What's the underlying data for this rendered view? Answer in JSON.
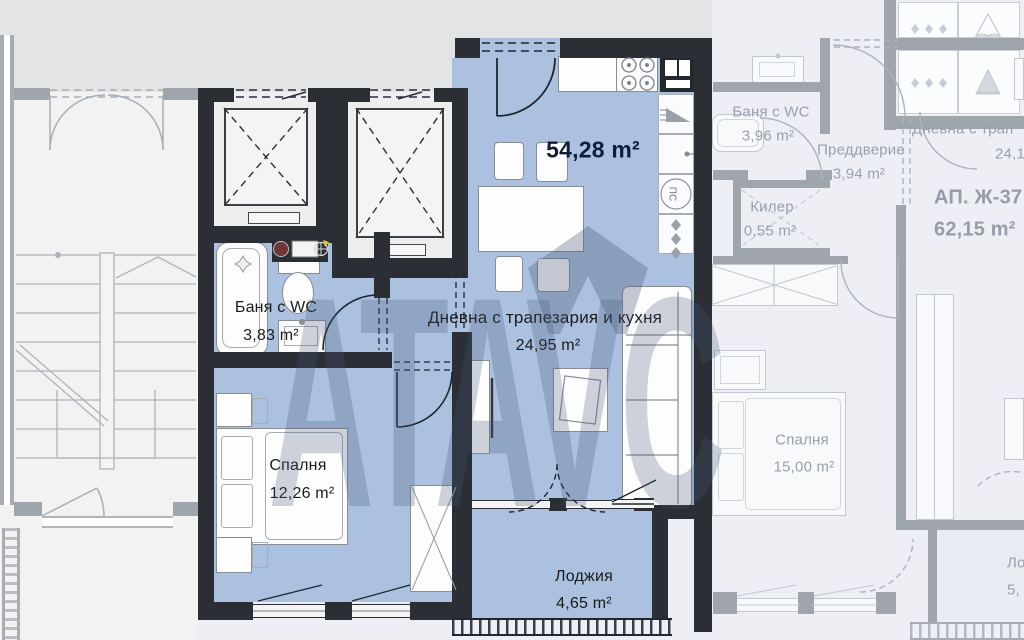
{
  "plan": {
    "watermark": {
      "text_left": "ATA",
      "text_right": "VC"
    },
    "main": {
      "total_area": "54,28 m²",
      "living": {
        "name": "Дневна с трапезария и кухня",
        "area": "24,95 m²"
      },
      "bathroom": {
        "name": "Баня с WC",
        "area": "3,83 m²"
      },
      "bedroom": {
        "name": "Спалня",
        "area": "12,26 m²"
      },
      "loggia": {
        "name": "Лоджия",
        "area": "4,65 m²"
      },
      "shaft_label": "ПС"
    },
    "adjacent": {
      "unit_label": "АП. Ж-37",
      "unit_area": "62,15 m²",
      "bathroom": {
        "name": "Баня с WC",
        "area": "3,96 m²"
      },
      "vestibule": {
        "name": "Преддверие",
        "area": "3,94 m²"
      },
      "closet": {
        "name": "Килер",
        "area": "0,55 m²"
      },
      "living": {
        "name": "Дневна с трап",
        "area": "24,1"
      },
      "bedroom": {
        "name": "Спалня",
        "area": "15,00 m²"
      },
      "loggia": {
        "name": "Ло",
        "area": "5,"
      }
    }
  },
  "colors": {
    "highlight_fill": "#abc1df",
    "main_wall": "#2b2f35",
    "neighbor_wall": "#9fa5ad",
    "label_text": "#191a1c",
    "total_area_text": "#0e1d38",
    "neighbor_text": "#99a0ac",
    "outside_bg": "#e3e4e5"
  }
}
